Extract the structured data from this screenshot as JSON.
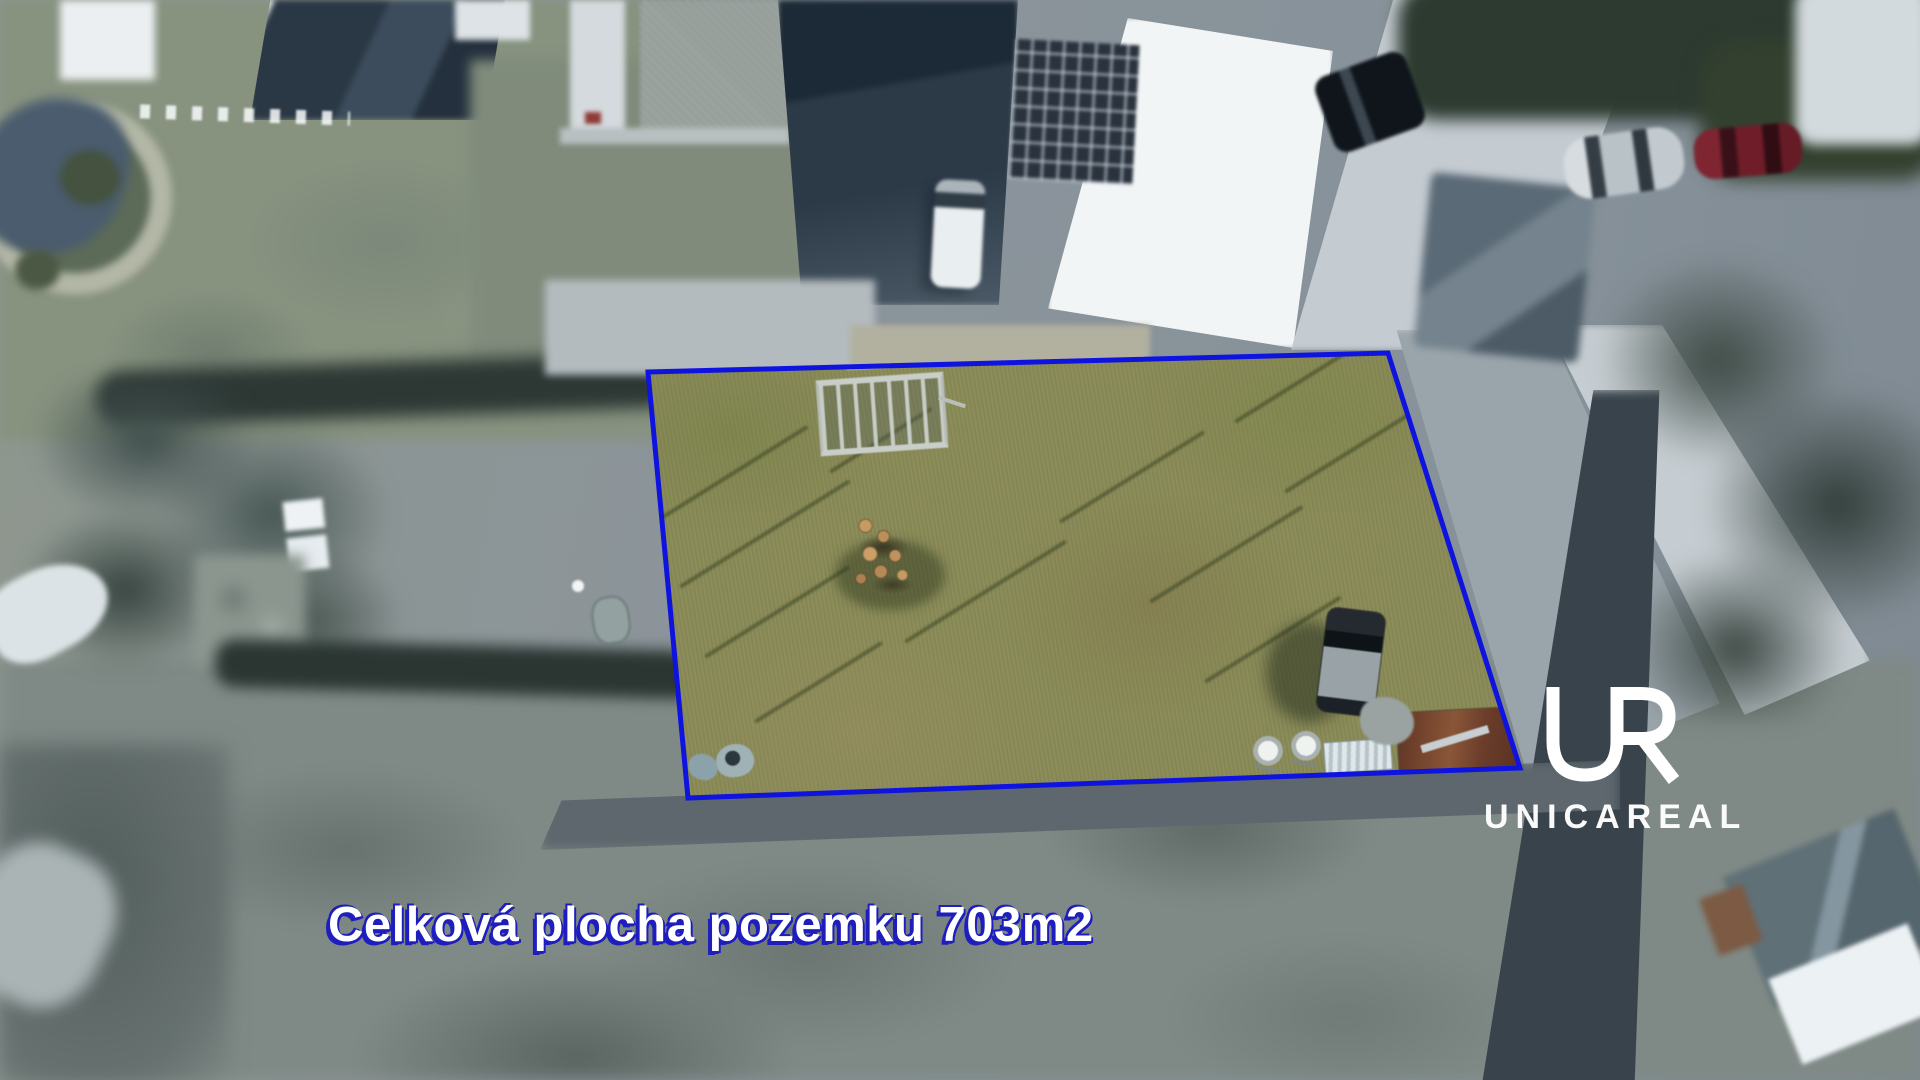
{
  "caption": {
    "text": "Celková plocha pozemku 703m2",
    "color": "#ffffff",
    "outline_color": "#1e1ebe"
  },
  "logo": {
    "monogram": "UR",
    "wordmark": "UNICAREAL",
    "color": "#ffffff"
  },
  "plot": {
    "area_m2": 703,
    "boundary_color": "#0f13df",
    "boundary_stroke_px": 5,
    "boundary_px": [
      [
        648,
        372
      ],
      [
        1388,
        353
      ],
      [
        1520,
        768
      ],
      [
        688,
        798
      ]
    ]
  },
  "scene": {
    "description_features": [
      {
        "name": "plot-grass",
        "color": "#8a8b58"
      },
      {
        "name": "surroundings-blurred",
        "color": "#8a949a"
      },
      {
        "name": "warehouse-white-roof",
        "color": "#f2f5f6"
      },
      {
        "name": "solar-panel-array",
        "color": "#2a333d"
      },
      {
        "name": "street-concrete",
        "color": "#c4cbd1"
      },
      {
        "name": "parked-car-black",
        "color": "#0f151b"
      },
      {
        "name": "parked-car-silver",
        "color": "#c2cacf"
      },
      {
        "name": "parked-car-red",
        "color": "#6f1d29"
      },
      {
        "name": "log-pile",
        "color": "#c59a63"
      },
      {
        "name": "utility-trailer-frame",
        "color": "#c9cec9"
      },
      {
        "name": "rusty-trailer",
        "color": "#7c4a30"
      },
      {
        "name": "car-on-plot",
        "color": "#98a2a7"
      },
      {
        "name": "cement-mixers",
        "color": "#f0f2f0"
      },
      {
        "name": "hedges-trees",
        "color": "#2c3a30"
      },
      {
        "name": "pond",
        "color": "#4a5c6e"
      }
    ]
  }
}
